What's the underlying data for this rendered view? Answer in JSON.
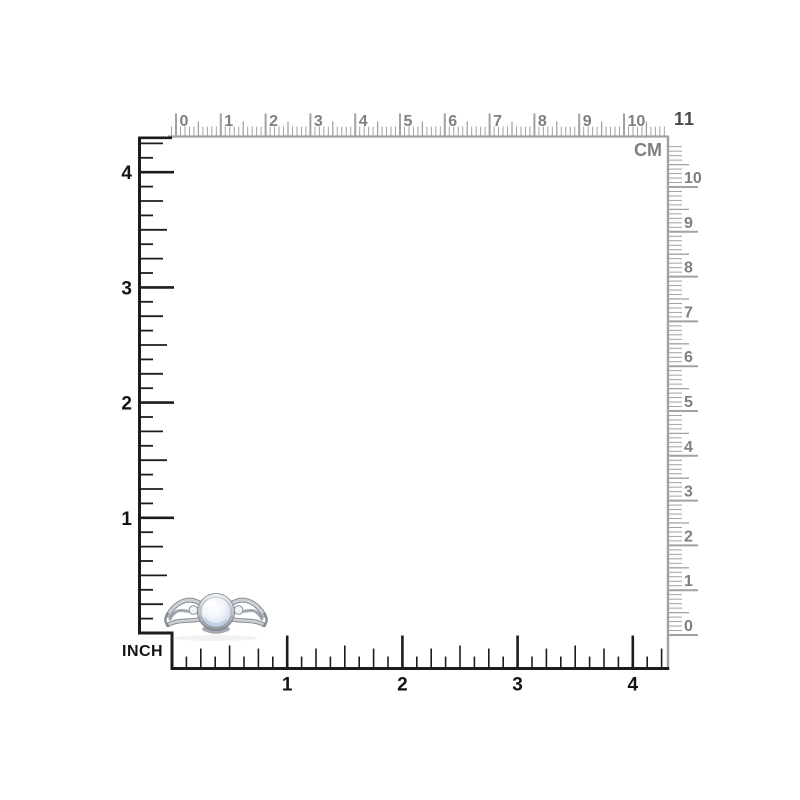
{
  "image": {
    "description": "Ring size chart with centimeter and inch rulers",
    "background": "#ffffff"
  },
  "colors": {
    "cm_tick": "#a2a2a2",
    "cm_number": "#7f7f7f",
    "corner_number": "#4a4a4a",
    "inch_tick": "#1c1c1c",
    "inch_number": "#141414"
  },
  "cm_ruler": {
    "unit_label": "CM",
    "corner_number": "11",
    "top_numbers": [
      "0",
      "1",
      "2",
      "3",
      "4",
      "5",
      "6",
      "7",
      "8",
      "9",
      "10"
    ],
    "right_numbers_top_to_bottom": [
      "10",
      "9",
      "8",
      "7",
      "6",
      "5",
      "4",
      "3",
      "2",
      "1",
      "0"
    ]
  },
  "inch_ruler": {
    "unit_label": "INCH",
    "left_numbers_top_to_bottom": [
      "4",
      "3",
      "2",
      "1"
    ],
    "bottom_numbers": [
      "1",
      "2",
      "3",
      "4"
    ]
  },
  "product": {
    "name": "silver moonstone ring",
    "metal_color": "#b4b9bf",
    "metal_dark_color": "#7e848b",
    "stone_color": "#e9eef8",
    "stone_glow_color": "#b9c8e4",
    "accent_stone_color": "#eef1f6"
  }
}
